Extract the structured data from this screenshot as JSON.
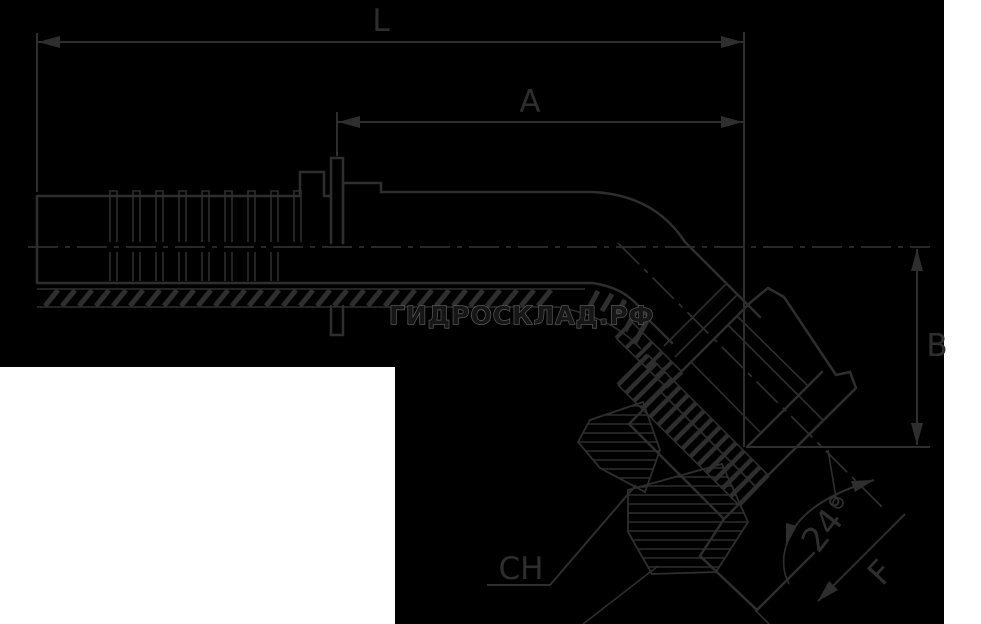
{
  "canvas": {
    "width": 981,
    "height": 624
  },
  "colors": {
    "drawing_background": "#000000",
    "page_background": "#ffffff",
    "line": "#2e2e2e",
    "watermark": "#5a5a5a"
  },
  "labels": {
    "overall_length": "L",
    "shank_length": "A",
    "elbow_height": "B",
    "wrench_size": "CH",
    "cone_angle": "24°",
    "thread_size": "F"
  },
  "watermark": {
    "text": "ГИДРОСКЛАД.РФ"
  }
}
